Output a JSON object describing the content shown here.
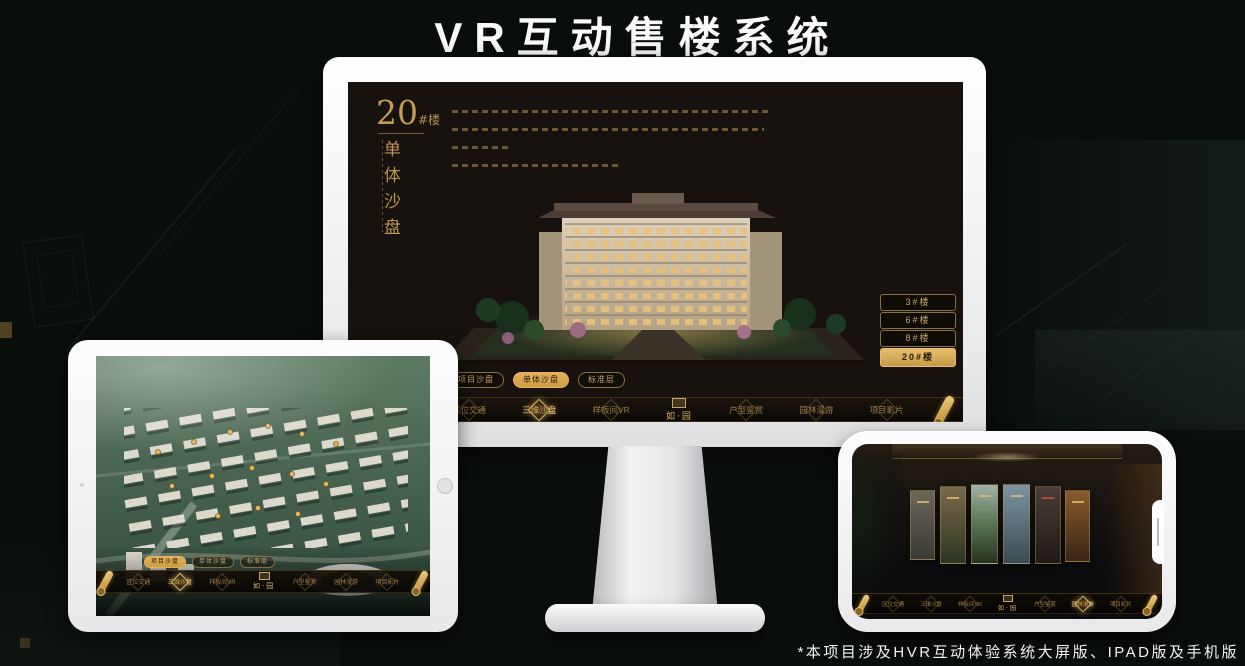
{
  "header": {
    "title": "VR互动售楼系统"
  },
  "footer": {
    "note": "*本项目涉及HVR互动体验系统大屏版、IPAD版及手机版"
  },
  "colors": {
    "gold": "#c9a365",
    "gold_bright": "#efc878",
    "screen_bg": "#17120d"
  },
  "monitor": {
    "hero": {
      "number": "20",
      "unit": "#楼",
      "subtitle": "单体沙盘"
    },
    "floor_buttons": [
      {
        "label": "3#楼",
        "selected": false
      },
      {
        "label": "6#楼",
        "selected": false
      },
      {
        "label": "8#楼",
        "selected": false
      },
      {
        "label": "20#楼",
        "selected": true
      }
    ],
    "tabs": [
      {
        "label": "项目沙盘",
        "selected": false
      },
      {
        "label": "单体沙盘",
        "selected": true
      },
      {
        "label": "标准层",
        "selected": false
      }
    ],
    "nav": {
      "logo": "如·园",
      "items": [
        {
          "label": "区位交通",
          "active": false
        },
        {
          "label": "三维沙盘",
          "active": true
        },
        {
          "label": "样板间VR",
          "active": false
        },
        {
          "label": "户型鉴赏",
          "active": false
        },
        {
          "label": "园林漫游",
          "active": false
        },
        {
          "label": "项目影片",
          "active": false
        }
      ]
    }
  },
  "ipad": {
    "tabs": [
      {
        "label": "项目沙盘",
        "selected": true
      },
      {
        "label": "单体沙盘",
        "selected": false
      },
      {
        "label": "标准层",
        "selected": false
      }
    ],
    "nav": {
      "logo": "如·园",
      "items": [
        {
          "label": "区位交通",
          "active": false
        },
        {
          "label": "三维沙盘",
          "active": true
        },
        {
          "label": "样板间VR",
          "active": false
        },
        {
          "label": "户型鉴赏",
          "active": false
        },
        {
          "label": "园林漫游",
          "active": false
        },
        {
          "label": "项目影片",
          "active": false
        }
      ]
    }
  },
  "phone": {
    "nav": {
      "logo": "如·园",
      "items": [
        {
          "label": "区位交通",
          "active": false
        },
        {
          "label": "三维沙盘",
          "active": false
        },
        {
          "label": "样板间VR",
          "active": false
        },
        {
          "label": "户型鉴赏",
          "active": false
        },
        {
          "label": "园林漫游",
          "active": true
        },
        {
          "label": "项目影片",
          "active": false
        }
      ]
    }
  }
}
